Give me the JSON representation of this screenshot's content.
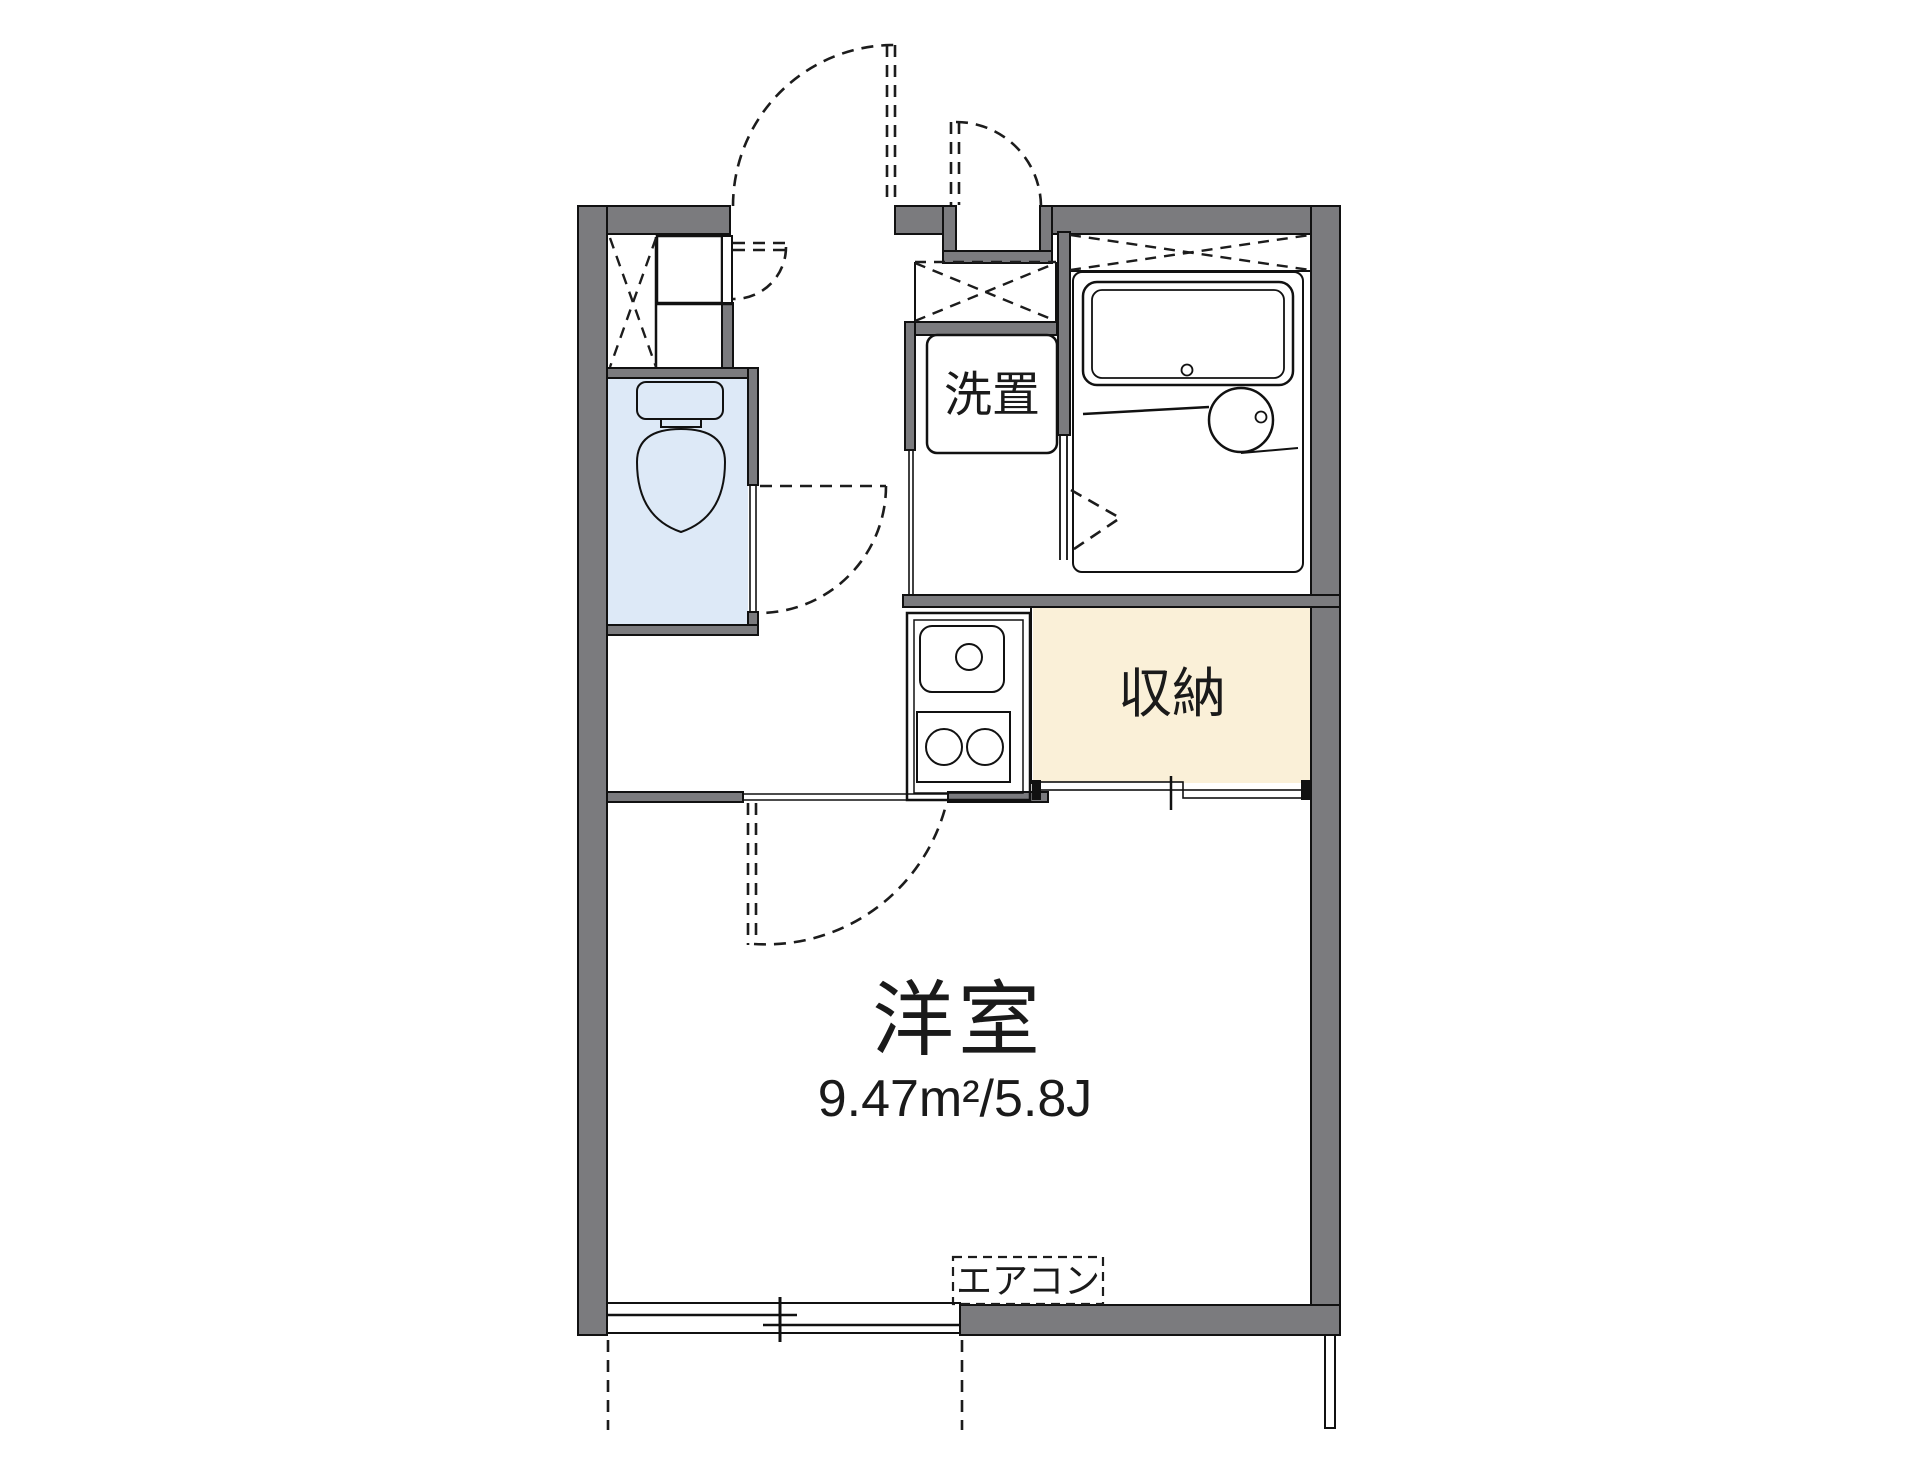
{
  "plan": {
    "type": "apartment-floorplan",
    "rooms": {
      "main_room": {
        "label": "洋室",
        "area_text": "9.47m²/5.8J"
      },
      "storage": {
        "label": "収納"
      },
      "laundry": {
        "label": "洗置"
      },
      "aircon": {
        "label": "エアコン"
      }
    },
    "colors": {
      "wall_gray": "#7b7b7e",
      "water_blue": "#dde9f7",
      "cream": "#faf0d8",
      "line_black": "#111111",
      "background": "#ffffff"
    }
  }
}
